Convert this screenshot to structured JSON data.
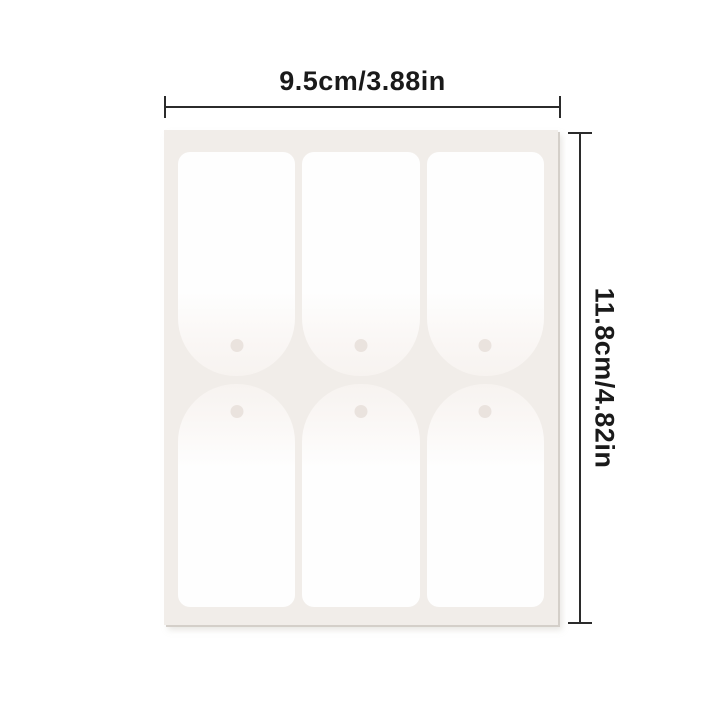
{
  "diagram": {
    "type": "product-dimension-diagram",
    "dimensions": {
      "width": {
        "label": "9.5cm/3.88in",
        "orientation": "horizontal",
        "position": "top"
      },
      "height": {
        "label": "11.8cm/4.82in",
        "orientation": "vertical",
        "position": "right"
      }
    },
    "sheet": {
      "description": "blank white hang-tag sticker sheet",
      "tag_count": 6,
      "rows": [
        {
          "orientation": "hole-bottom",
          "tags": 3
        },
        {
          "orientation": "hole-top",
          "tags": 3
        }
      ]
    },
    "colors": {
      "background": "#ffffff",
      "sheet": "#f1ede9",
      "tag": "#fefefe",
      "tag_shaded_end": "#f7f3f0",
      "hole": "#eae3de",
      "dimension_line": "#2b2b2b",
      "label_text": "#1a1a1a"
    }
  }
}
